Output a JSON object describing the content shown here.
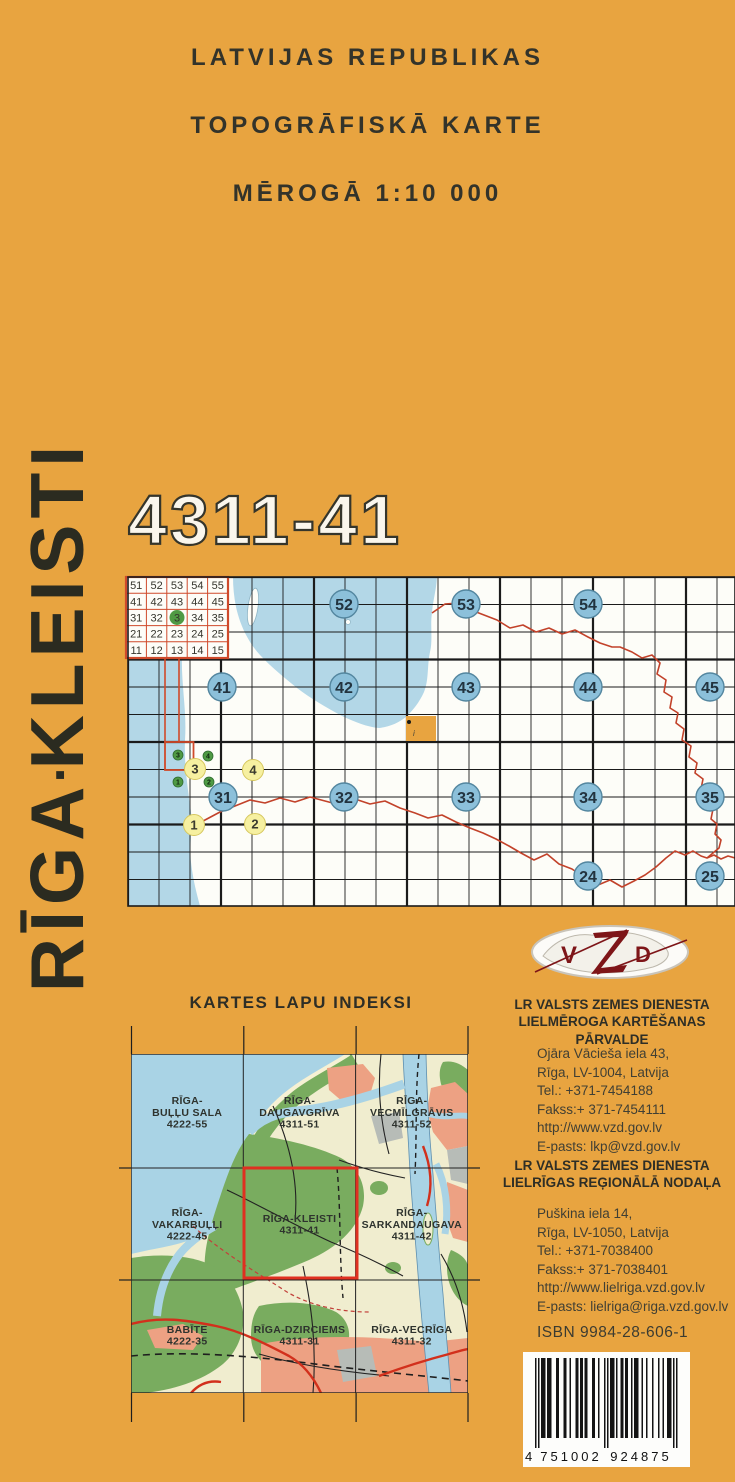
{
  "page": {
    "background": "#E8A440"
  },
  "header": {
    "line1": "LATVIJAS REPUBLIKAS",
    "line2": "TOPOGRĀFISKĀ KARTE",
    "line3": "MĒROGĀ 1:10 000"
  },
  "sheet_code": "4311-41",
  "side_title": {
    "part1": "RĪGA",
    "separator": "▪",
    "part2": "KLEISTI"
  },
  "index_map": {
    "mini_table": {
      "rows": [
        [
          "51",
          "52",
          "53",
          "54",
          "55"
        ],
        [
          "41",
          "42",
          "43",
          "44",
          "45"
        ],
        [
          "31",
          "32",
          "3",
          "34",
          "35"
        ],
        [
          "21",
          "22",
          "23",
          "24",
          "25"
        ],
        [
          "11",
          "12",
          "13",
          "14",
          "15"
        ]
      ],
      "highlight_row": 2,
      "highlight_col": 2
    },
    "blue_circles": [
      {
        "label": "52",
        "x": 344,
        "y": 604
      },
      {
        "label": "53",
        "x": 466,
        "y": 604
      },
      {
        "label": "54",
        "x": 588,
        "y": 604
      },
      {
        "label": "41",
        "x": 222,
        "y": 687
      },
      {
        "label": "42",
        "x": 344,
        "y": 687
      },
      {
        "label": "43",
        "x": 466,
        "y": 687
      },
      {
        "label": "44",
        "x": 588,
        "y": 687
      },
      {
        "label": "45",
        "x": 710,
        "y": 687
      },
      {
        "label": "31",
        "x": 223,
        "y": 797
      },
      {
        "label": "32",
        "x": 344,
        "y": 797
      },
      {
        "label": "33",
        "x": 466,
        "y": 797
      },
      {
        "label": "34",
        "x": 588,
        "y": 797
      },
      {
        "label": "35",
        "x": 710,
        "y": 797
      },
      {
        "label": "24",
        "x": 588,
        "y": 876
      },
      {
        "label": "25",
        "x": 710,
        "y": 876
      }
    ],
    "yellow_circles": [
      {
        "label": "3",
        "x": 195,
        "y": 769
      },
      {
        "label": "4",
        "x": 253,
        "y": 770
      },
      {
        "label": "1",
        "x": 194,
        "y": 825
      },
      {
        "label": "2",
        "x": 255,
        "y": 824
      }
    ],
    "green_circles": [
      {
        "label": "3",
        "x": 178,
        "y": 755
      },
      {
        "label": "4",
        "x": 208,
        "y": 756
      },
      {
        "label": "1",
        "x": 178,
        "y": 782
      },
      {
        "label": "2",
        "x": 209,
        "y": 782
      }
    ]
  },
  "sheet_index": {
    "title": "KARTES LAPU INDEKSI",
    "sheets": [
      {
        "row": 0,
        "col": 0,
        "lines": [
          "RĪGA-",
          "BUĻĻU SALA",
          "4222-55"
        ]
      },
      {
        "row": 0,
        "col": 1,
        "lines": [
          "RĪGA-",
          "DAUGAVGRĪVA",
          "4311-51"
        ]
      },
      {
        "row": 0,
        "col": 2,
        "lines": [
          "RĪGA-",
          "VECMĪLGRĀVIS",
          "4311-52"
        ]
      },
      {
        "row": 1,
        "col": 0,
        "lines": [
          "RĪGA-",
          "VAKARBUĻĻI",
          "4222-45"
        ]
      },
      {
        "row": 1,
        "col": 1,
        "lines": [
          "RĪGA-KLEISTI",
          "4311-41"
        ],
        "highlighted": true
      },
      {
        "row": 1,
        "col": 2,
        "lines": [
          "RĪGA-",
          "SARKANDAUGAVA",
          "4311-42"
        ]
      },
      {
        "row": 2,
        "col": 0,
        "lines": [
          "BABĪTE",
          "4222-35"
        ]
      },
      {
        "row": 2,
        "col": 1,
        "lines": [
          "RĪGA-DZIRCIEMS",
          "4311-31"
        ]
      },
      {
        "row": 2,
        "col": 2,
        "lines": [
          "RĪGA-VECRĪGA",
          "4311-32"
        ]
      }
    ]
  },
  "logo": {
    "v": "V",
    "z": "Z",
    "d": "D"
  },
  "organizations": [
    {
      "name_line1": "LR VALSTS ZEMES DIENESTA",
      "name_line2": "LIELMĒROGA KARTĒŠANAS PĀRVALDE",
      "address_lines": [
        "Ojāra Vācieša  iela 43,",
        "Rīga, LV-1004, Latvija",
        "Tel.: +371-7454188",
        "Fakss:+ 371-7454111",
        "http://www.vzd.gov.lv",
        "E-pasts: lkp@vzd.gov.lv"
      ]
    },
    {
      "name_line1": "LR VALSTS ZEMES DIENESTA",
      "name_line2": "LIELRĪGAS REĢIONĀLĀ NODAĻA",
      "address_lines": [
        "Puškina iela 14,",
        "Rīga, LV-1050, Latvija",
        "Tel.: +371-7038400",
        "Fakss:+ 371-7038401",
        "http://www.lielriga.vzd.gov.lv",
        "E-pasts: lielriga@riga.vzd.gov.lv"
      ]
    }
  ],
  "isbn": "ISBN 9984-28-606-1",
  "barcode": {
    "digits": "4751002924875",
    "lead_digit": "4",
    "group1": "751002",
    "group2": "924875"
  }
}
